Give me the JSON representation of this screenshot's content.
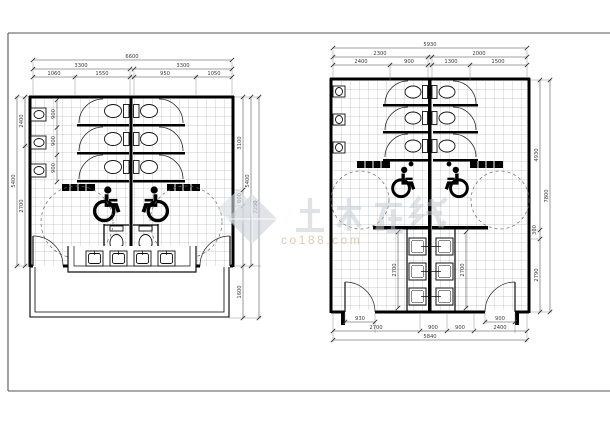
{
  "watermark": {
    "brand": "土木在线",
    "site": "co188.com"
  },
  "left_plan": {
    "title": "left-restroom-plan",
    "dims": {
      "overall_width": "6600",
      "left_half": "3300",
      "right_half": "3300",
      "detail_1": "1060",
      "detail_2": "1550",
      "detail_3": "950",
      "detail_4": "1050",
      "left_overall": "5400",
      "left_upper": "2400",
      "left_lower": "2700",
      "stall_1": "900",
      "stall_2": "900",
      "stall_3": "900",
      "right_upper": "3100",
      "right_small": "600",
      "right_lower": "1600",
      "right_mid_overall": "5400",
      "right_outer_overall": "7250"
    }
  },
  "right_plan": {
    "title": "right-restroom-plan",
    "dims": {
      "overall_width": "5930",
      "left_half": "2300",
      "right_half": "2000",
      "detail_1": "2400",
      "detail_2": "900",
      "detail_3": "1300",
      "detail_4": "1500",
      "door_left": "930",
      "door_right": "900",
      "bottom_1": "2700",
      "bottom_2": "900",
      "bottom_3": "900",
      "bottom_4": "2400",
      "bottom_overall": "5840",
      "right_upper": "4930",
      "right_small": "300",
      "right_lower": "2790",
      "right_overall": "7800",
      "interior_left": "2700",
      "interior_right": "2700"
    }
  }
}
